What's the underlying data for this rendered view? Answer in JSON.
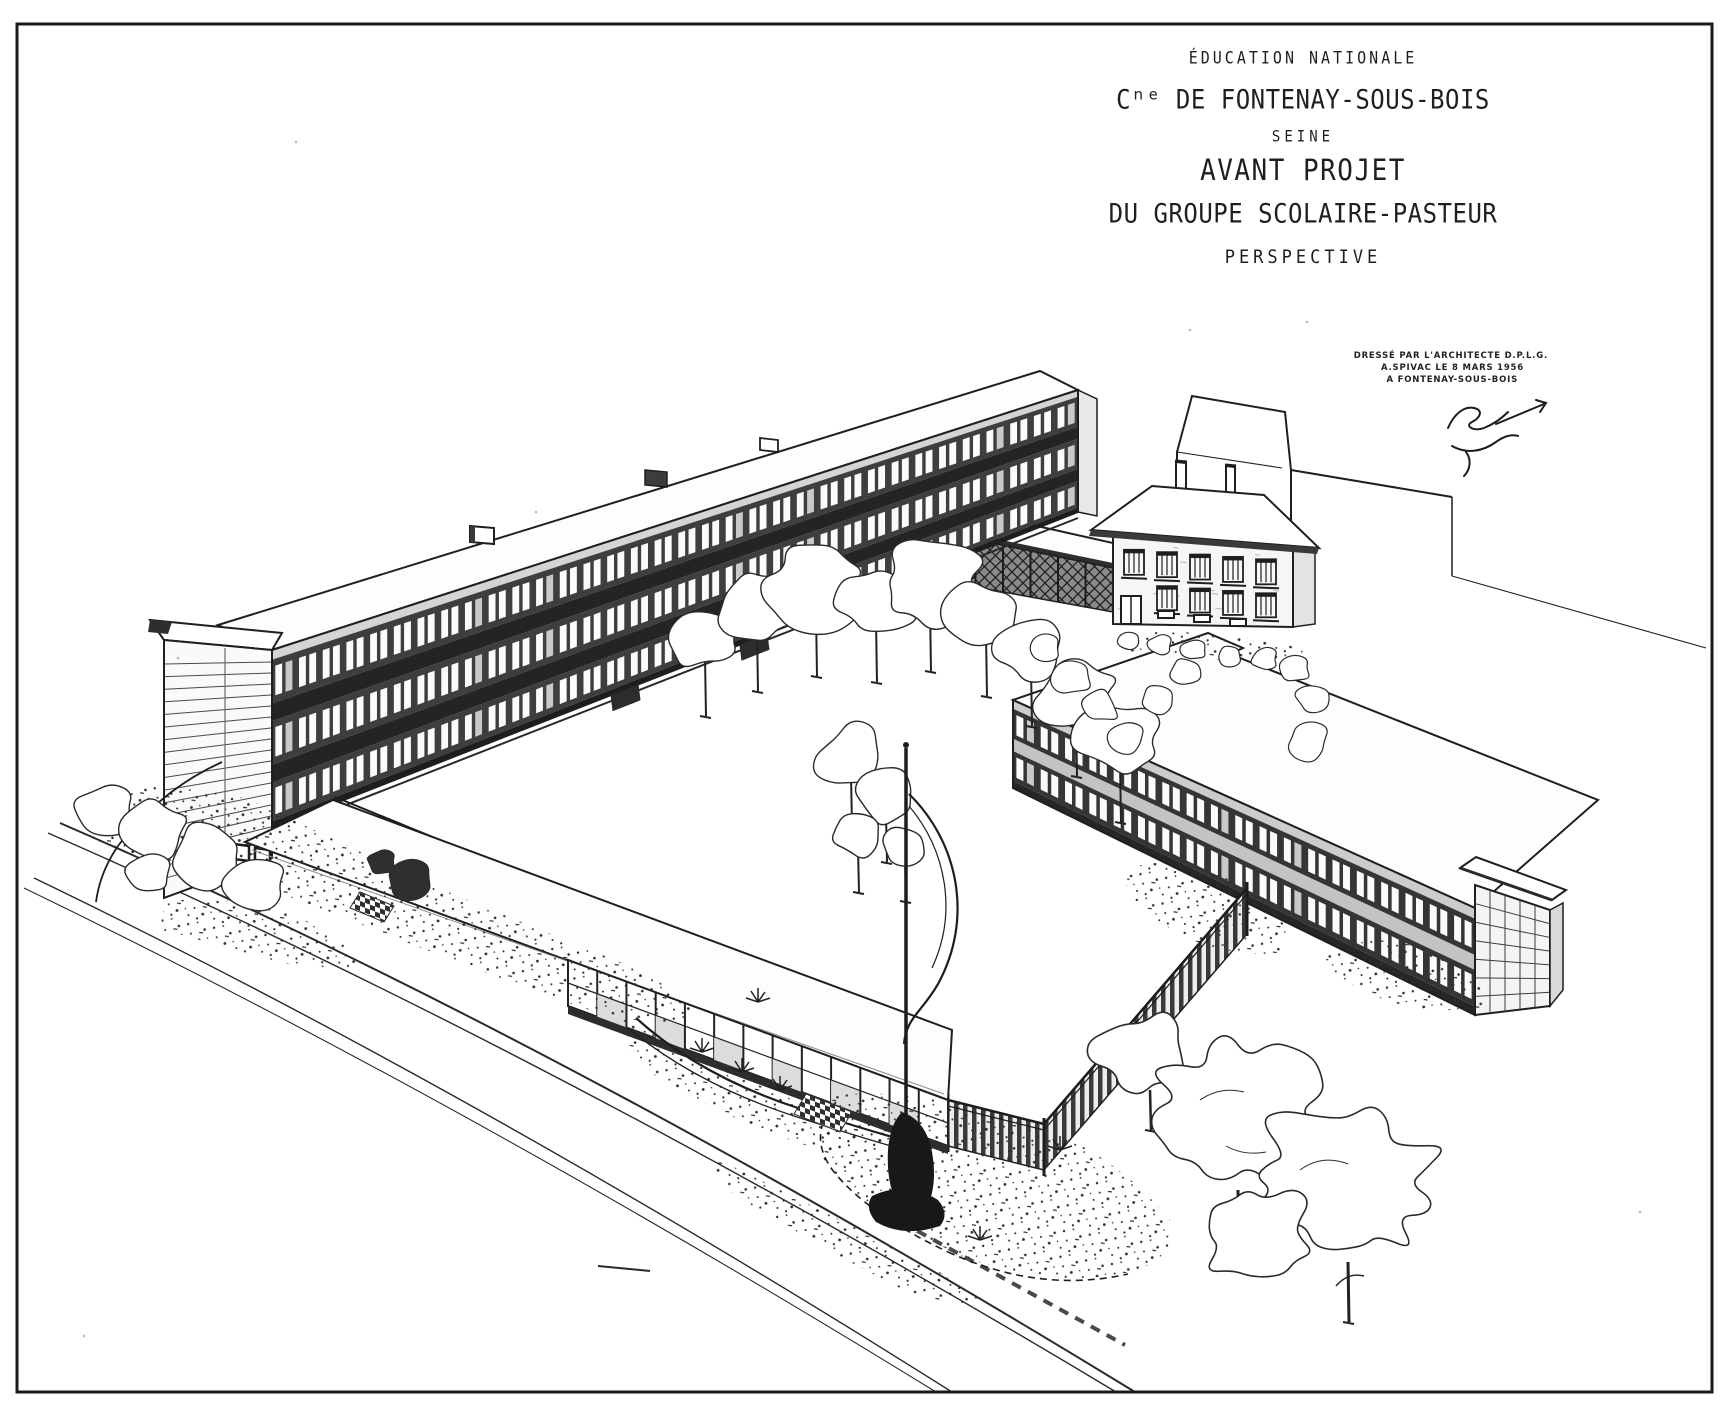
{
  "document": {
    "colors": {
      "ink": "#1f1f1f",
      "paper": "#ffffff",
      "facade_dark": "#3e3e3e"
    },
    "title_block": {
      "ministry": "ÉDUCATION NATIONALE",
      "commune": "Cⁿᵉ DE FONTENAY-SOUS-BOIS",
      "department": "SEINE",
      "project_line1": "AVANT PROJET",
      "project_line2": "DU GROUPE SCOLAIRE-PASTEUR",
      "drawing_type": "PERSPECTIVE"
    },
    "architect_block": {
      "line1": "DRESSÉ PAR L'ARCHITECTE D.P.L.G.",
      "line2": "A.SPIVAC LE 8 MARS 1956",
      "line3": "A FONTENAY-SOUS-BOIS"
    }
  }
}
